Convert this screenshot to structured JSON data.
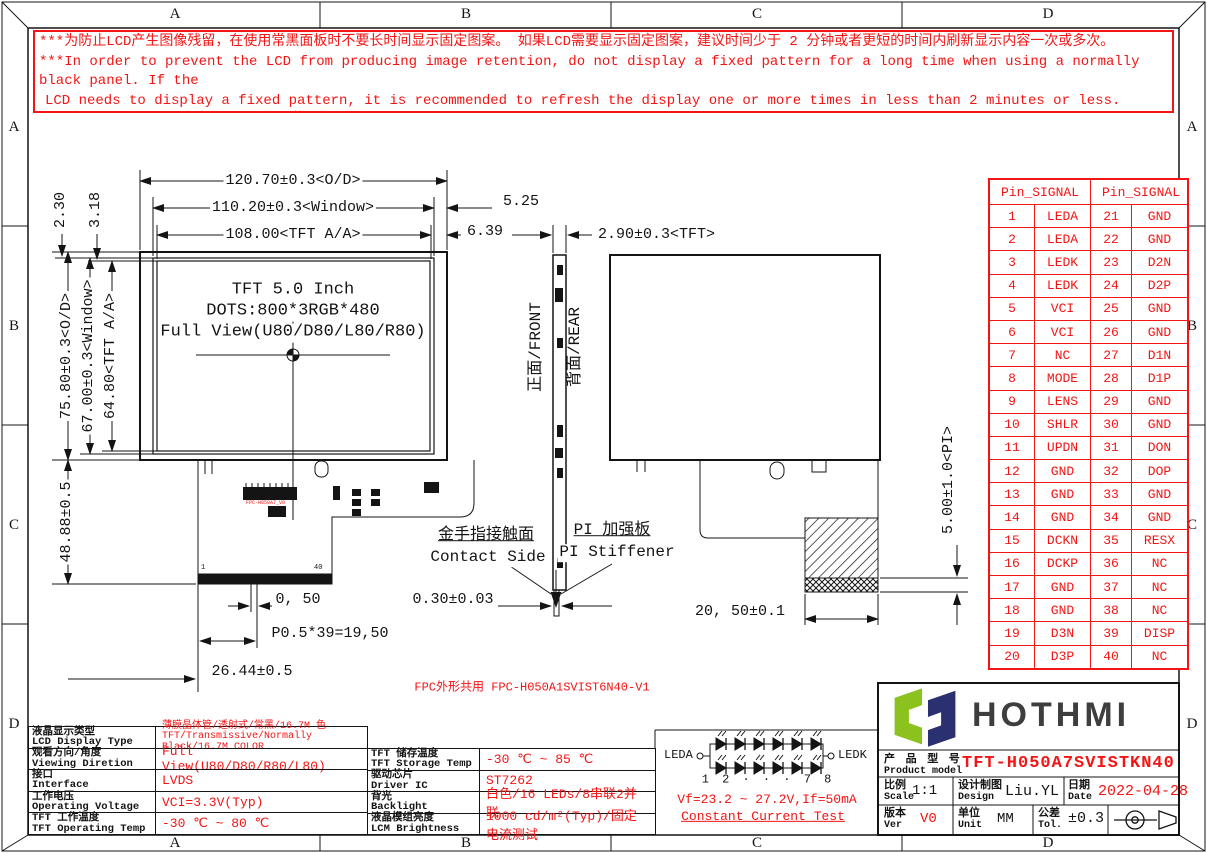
{
  "frame": {
    "top": [
      "A",
      "B",
      "C",
      "D"
    ],
    "bottom": [
      "A",
      "B",
      "C",
      "D"
    ],
    "left": [
      "A",
      "B",
      "C",
      "D"
    ],
    "right": [
      "A",
      "B",
      "C",
      "D"
    ]
  },
  "warning": {
    "lines": [
      "***为防止LCD产生图像残留，在使用常黑面板时不要长时间显示固定图案。 如果LCD需要显示固定图案，建议时间少于 2 分钟或者更短的时间内刷新显示内容一次或多次。",
      "***In order to prevent the LCD from producing image retention, do not display a fixed pattern for a long time when using a normally black panel. If the",
      "LCD needs to display a fixed pattern, it is recommended to refresh the display one or more times in less than 2 minutes or less.",
      "强烈建议使用黑色图像或移动图像作为屏幕保护程序。It is strongly recommended to use a black image or moving image as a screen saver."
    ]
  },
  "front_view": {
    "title": "TFT 5.0 Inch",
    "dots": "DOTS:800*3RGB*480",
    "view": "Full View(U80/D80/L80/R80)",
    "fpc_label": "FPC-H050A7_V0",
    "pin_first": "1",
    "pin_last": "40"
  },
  "dimensions": {
    "od_width": "120.70±0.3<O/D>",
    "window_width": "110.20±0.3<Window>",
    "aa_width": "108.00<TFT A/A>",
    "gap_525": "5.25",
    "gap_639": "6.39",
    "tft_thickness": "2.90±0.3<TFT>",
    "gap_230": "2.30",
    "gap_318": "3.18",
    "od_height": "75.80±0.3<O/D>",
    "window_height": "67.00±0.3<Window>",
    "aa_height": "64.80<TFT A/A>",
    "fpc_height": "48.88±0.5",
    "pin_width": "0, 50",
    "pin_pitch": "P0.5*39=19,50",
    "fpc_left": "26.44±0.5",
    "fpc_thickness": "0.30±0.03",
    "stiffener_width": "20, 50±0.1",
    "pi_height": "5.00±1.0<PI>"
  },
  "side_view": {
    "front_label": "正面/FRONT",
    "rear_label": "背面/REAR"
  },
  "callouts": {
    "contact_cn": "金手指接触面",
    "contact_en": "Contact Side",
    "stiffener_cn": "PI 加强板",
    "stiffener_en": "PI Stiffener"
  },
  "fpc_note": "FPC外形共用 FPC-H050A1SVIST6N40-V1",
  "pin_table": {
    "header_left": "Pin_SIGNAL",
    "header_right": "Pin_SIGNAL",
    "rows": [
      [
        "1",
        "LEDA",
        "21",
        "GND"
      ],
      [
        "2",
        "LEDA",
        "22",
        "GND"
      ],
      [
        "3",
        "LEDK",
        "23",
        "D2N"
      ],
      [
        "4",
        "LEDK",
        "24",
        "D2P"
      ],
      [
        "5",
        "VCI",
        "25",
        "GND"
      ],
      [
        "6",
        "VCI",
        "26",
        "GND"
      ],
      [
        "7",
        "NC",
        "27",
        "D1N"
      ],
      [
        "8",
        "MODE",
        "28",
        "D1P"
      ],
      [
        "9",
        "LENS",
        "29",
        "GND"
      ],
      [
        "10",
        "SHLR",
        "30",
        "GND"
      ],
      [
        "11",
        "UPDN",
        "31",
        "DON"
      ],
      [
        "12",
        "GND",
        "32",
        "DOP"
      ],
      [
        "13",
        "GND",
        "33",
        "GND"
      ],
      [
        "14",
        "GND",
        "34",
        "GND"
      ],
      [
        "15",
        "DCKN",
        "35",
        "RESX"
      ],
      [
        "16",
        "DCKP",
        "36",
        "NC"
      ],
      [
        "17",
        "GND",
        "37",
        "NC"
      ],
      [
        "18",
        "GND",
        "38",
        "NC"
      ],
      [
        "19",
        "D3N",
        "39",
        "DISP"
      ],
      [
        "20",
        "D3P",
        "40",
        "NC"
      ]
    ]
  },
  "specs_left": [
    {
      "cn": "液晶显示类型",
      "en": "LCD Display Type",
      "value": "薄膜晶体管/透射式/常黑/16.7M 色",
      "value2": "TFT/Transmissive/Normally Black/16.7M COLOR"
    },
    {
      "cn": "观看方向/角度",
      "en": "Viewing Diretion",
      "value": "Full View(U80/D80/R80/L80)"
    },
    {
      "cn": "接口",
      "en": "Interface",
      "value": "LVDS"
    },
    {
      "cn": "工作电压",
      "en": "Operating Voltage",
      "value": "VCI=3.3V(Typ)"
    },
    {
      "cn": "TFT 工作温度",
      "en": "TFT Operating Temp",
      "value": "-30 ℃ ~ 80 ℃"
    }
  ],
  "specs_right": [
    {
      "cn": "TFT 储存温度",
      "en": "TFT Storage Temp",
      "value": "-30 ℃ ~ 85 ℃"
    },
    {
      "cn": "驱动芯片",
      "en": "Driver IC",
      "value": "ST7262"
    },
    {
      "cn": "背光",
      "en": "Backlight",
      "value": "白色/16 LEDs/8串联2并联"
    },
    {
      "cn": "液晶模组亮度",
      "en": "LCM Brightness",
      "value": "1000 cd/m²(Typ)/固定电流测试"
    }
  ],
  "led_circuit": {
    "anode": "LEDA",
    "cathode": "LEDK",
    "index_row": "1 2 · · · 7 8",
    "vf": "Vf=23.2 ~ 27.2V,If=50mA",
    "test": "Constant Current Test"
  },
  "title_block": {
    "brand": "HOTHMI",
    "model_label_cn": "产 品 型 号",
    "model_label_en": "Product model",
    "model": "TFT-H050A7SVISTKN40",
    "scale_cn": "比例",
    "scale_en": "Scale",
    "scale": "1:1",
    "design_cn": "设计制图",
    "design_en": "Design",
    "designer": "Liu.YL",
    "date_cn": "日期",
    "date_en": "Date",
    "date": "2022-04-28",
    "ver_cn": "版本",
    "ver_en": "Ver",
    "ver": "V0",
    "unit_cn": "单位",
    "unit_en": "Unit",
    "unit": "MM",
    "tol_cn": "公差",
    "tol_en": "Tol.",
    "tol": "±0.3"
  },
  "colors": {
    "annotation_red": "#f41414",
    "logo_green": "#8cc21e",
    "logo_navy": "#2b3070",
    "line_black": "#141414"
  }
}
